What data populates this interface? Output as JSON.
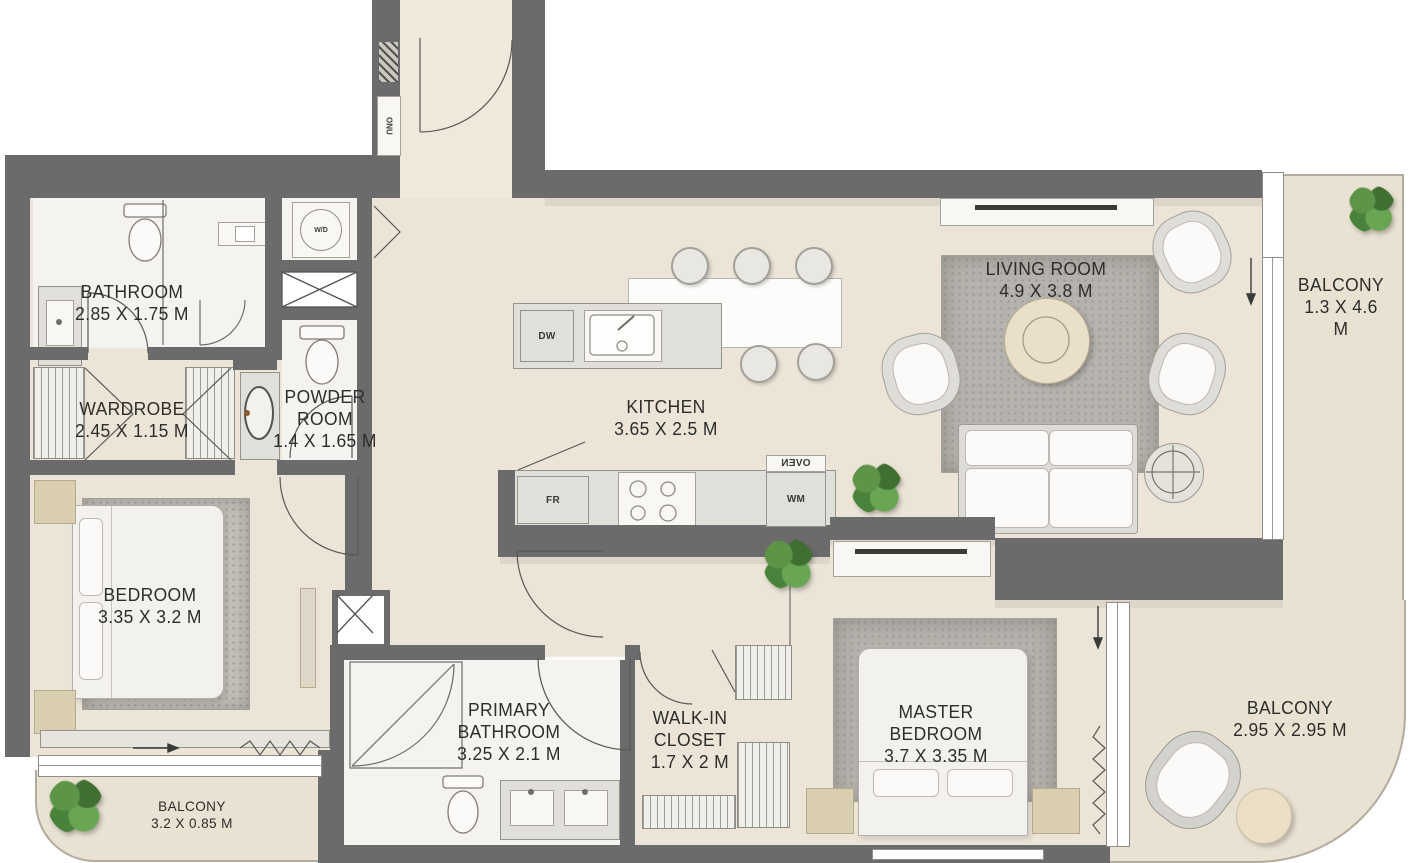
{
  "plan": {
    "type": "apartment-floor-plan",
    "units": "M",
    "rooms": [
      {
        "name": "BATHROOM",
        "dims": "2.85 X 1.75 M"
      },
      {
        "name": "WARDROBE",
        "dims": "2.45 X 1.15 M"
      },
      {
        "name": "POWDER\nROOM",
        "dims": "1.4 X 1.65 M"
      },
      {
        "name": "KITCHEN",
        "dims": "3.65 X 2.5 M"
      },
      {
        "name": "LIVING ROOM",
        "dims": "4.9 X 3.8 M"
      },
      {
        "name": "BALCONY",
        "dims": "1.3 X 4.6 M"
      },
      {
        "name": "BEDROOM",
        "dims": "3.35 X 3.2 M"
      },
      {
        "name": "BALCONY",
        "dims": "3.2 X 0.85 M"
      },
      {
        "name": "PRIMARY\nBATHROOM",
        "dims": "3.25 X 2.1 M"
      },
      {
        "name": "WALK-IN\nCLOSET",
        "dims": "1.7 X 2 M"
      },
      {
        "name": "MASTER\nBEDROOM",
        "dims": "3.7 X 3.35 M"
      },
      {
        "name": "BALCONY",
        "dims": "2.95 X 2.95 M"
      }
    ],
    "fixtures": {
      "dishwasher": "DW",
      "fridge": "FR",
      "washing_machine": "WM",
      "oven": "OVEN",
      "washer_dryer": "W/D",
      "telecom_unit": "ONU"
    },
    "colors": {
      "wall": "#6B6B6B",
      "floor": "#ECE5D7",
      "balcony_floor": "#E9E1D1",
      "tile": "#F4F3F0",
      "rug": "#B6B2AD",
      "plant_green": "#4E8540",
      "text": "#2D2D2B"
    }
  }
}
